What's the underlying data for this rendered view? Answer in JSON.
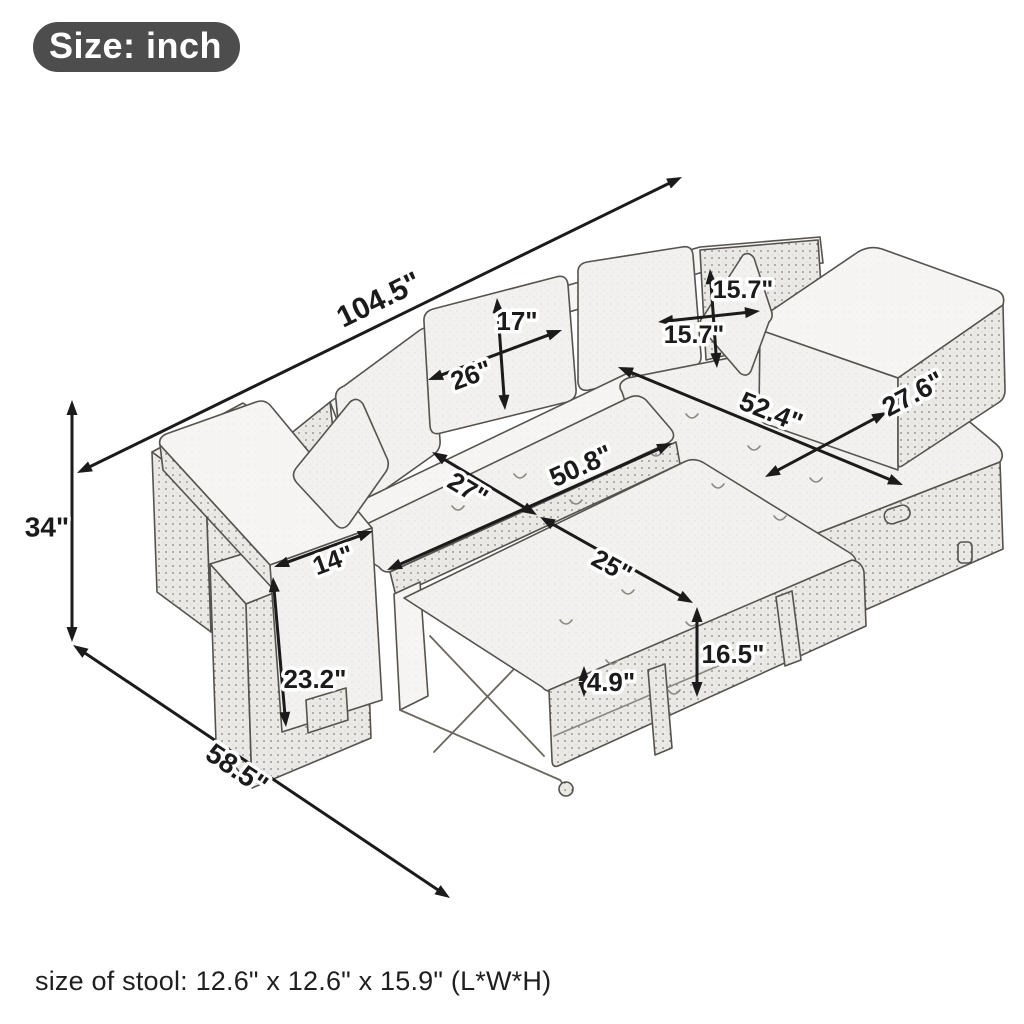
{
  "badge": {
    "label": "Size: inch"
  },
  "caption": "size of stool: 12.6\" x 12.6\" x 15.9\" (L*W*H)",
  "unit": "inch",
  "colors": {
    "badge_bg": "#4d4d4d",
    "ink": "#1b1b1b",
    "fabric": "#f2f1ef",
    "background": "#ffffff"
  },
  "illustration": {
    "description": "hand-drawn sketch of an L-shaped pull-out sleeper sectional with storage chaise, left armrest console and two nesting stools, two throw pillows"
  },
  "dimensions": [
    {
      "id": "overall-length",
      "label": "104.5\"",
      "x1": 77,
      "y1": 473,
      "x2": 682,
      "y2": 177,
      "lx": 379,
      "ly": 300,
      "rot": -26,
      "size": 30
    },
    {
      "id": "overall-height",
      "label": "34\"",
      "x1": 72,
      "y1": 400,
      "x2": 72,
      "y2": 642,
      "lx": 47,
      "ly": 527,
      "rot": 0,
      "size": 28
    },
    {
      "id": "overall-depth",
      "label": "58.5\"",
      "x1": 73,
      "y1": 645,
      "x2": 450,
      "y2": 898,
      "lx": 237,
      "ly": 769,
      "rot": 34,
      "size": 28
    },
    {
      "id": "armrest-width",
      "label": "14\"",
      "x1": 274,
      "y1": 567,
      "x2": 373,
      "y2": 531,
      "lx": 333,
      "ly": 560,
      "rot": -20,
      "size": 26
    },
    {
      "id": "armrest-height",
      "label": "23.2\"",
      "x1": 273,
      "y1": 577,
      "x2": 286,
      "y2": 727,
      "lx": 315,
      "ly": 679,
      "rot": 0,
      "size": 26
    },
    {
      "id": "back-cushion-height",
      "label": "17\"",
      "x1": 497,
      "y1": 298,
      "x2": 505,
      "y2": 410,
      "lx": 517,
      "ly": 321,
      "rot": 0,
      "size": 26
    },
    {
      "id": "back-cushion-width",
      "label": "26\"",
      "x1": 428,
      "y1": 380,
      "x2": 562,
      "y2": 330,
      "lx": 471,
      "ly": 375,
      "rot": -20,
      "size": 26
    },
    {
      "id": "pillow-height",
      "label": "15.7\"",
      "x1": 710,
      "y1": 269,
      "x2": 717,
      "y2": 368,
      "lx": 743,
      "ly": 290,
      "rot": 0,
      "size": 25
    },
    {
      "id": "pillow-width",
      "label": "15.7\"",
      "x1": 658,
      "y1": 322,
      "x2": 760,
      "y2": 311,
      "lx": 694,
      "ly": 335,
      "rot": 0,
      "size": 25
    },
    {
      "id": "chaise-length",
      "label": "52.4\"",
      "x1": 618,
      "y1": 367,
      "x2": 903,
      "y2": 485,
      "lx": 771,
      "ly": 412,
      "rot": 22,
      "size": 27
    },
    {
      "id": "chaise-width",
      "label": "27.6\"",
      "x1": 765,
      "y1": 477,
      "x2": 887,
      "y2": 412,
      "lx": 913,
      "ly": 394,
      "rot": -28,
      "size": 27
    },
    {
      "id": "seat-depth",
      "label": "27\"",
      "x1": 432,
      "y1": 452,
      "x2": 537,
      "y2": 515,
      "lx": 468,
      "ly": 489,
      "rot": 31,
      "size": 26
    },
    {
      "id": "bed-width",
      "label": "50.8\"",
      "x1": 387,
      "y1": 570,
      "x2": 672,
      "y2": 443,
      "lx": 581,
      "ly": 466,
      "rot": -24,
      "size": 27
    },
    {
      "id": "bed-extension-depth",
      "label": "25\"",
      "x1": 540,
      "y1": 517,
      "x2": 693,
      "y2": 603,
      "lx": 612,
      "ly": 566,
      "rot": 29,
      "size": 26
    },
    {
      "id": "bed-height",
      "label": "16.5\"",
      "x1": 697,
      "y1": 607,
      "x2": 697,
      "y2": 697,
      "lx": 733,
      "ly": 654,
      "rot": 0,
      "size": 26
    },
    {
      "id": "mattress-step-height",
      "label": "4.9\"",
      "x1": 584,
      "y1": 666,
      "x2": 584,
      "y2": 697,
      "lx": 611,
      "ly": 682,
      "rot": 0,
      "size": 26
    }
  ]
}
